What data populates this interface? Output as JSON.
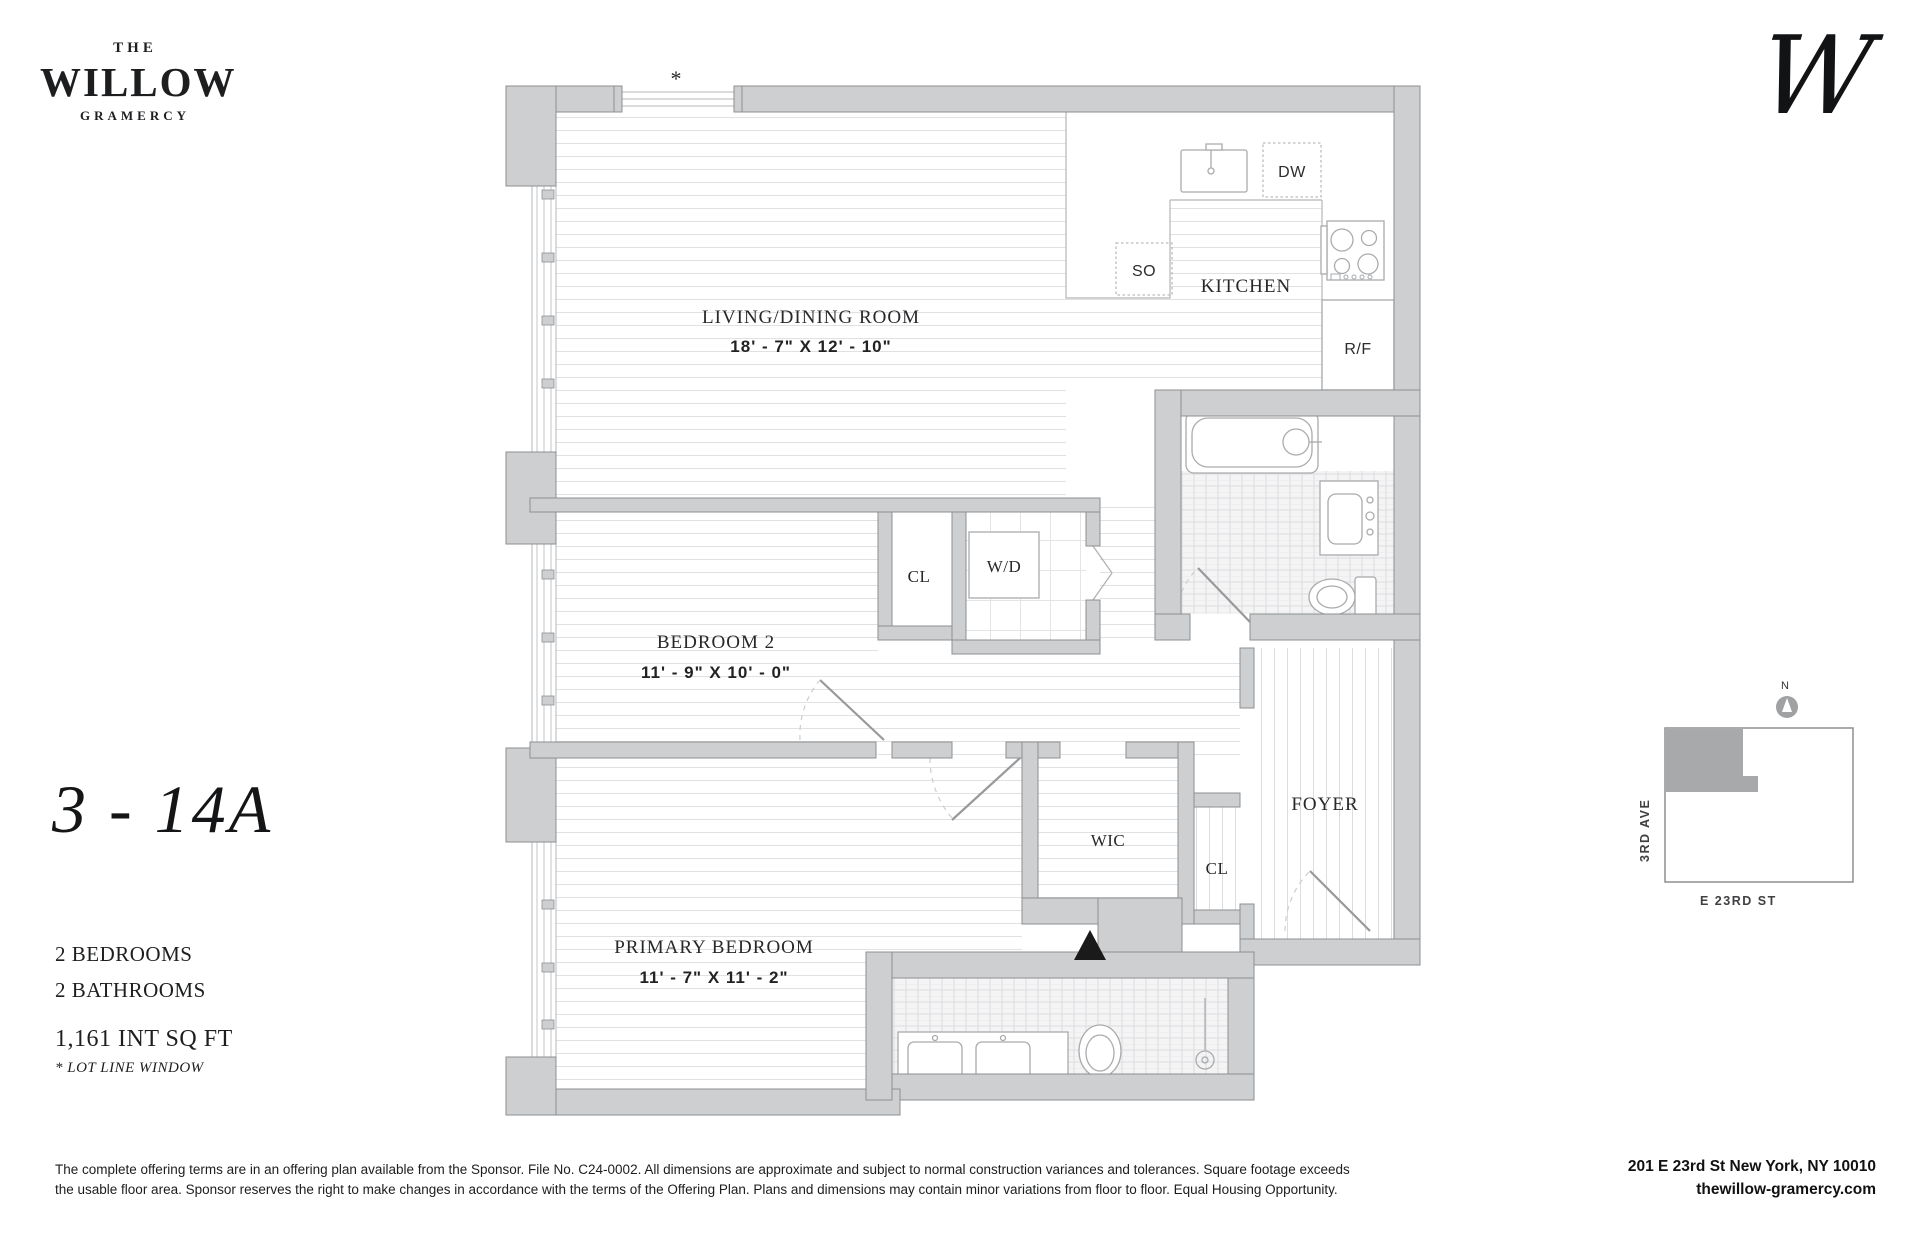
{
  "brand": {
    "the": "THE",
    "name": "WILLOW",
    "sub": "GRAMERCY",
    "monogram": "W"
  },
  "unit": {
    "number": "3 - 14A",
    "bedrooms": "2 BEDROOMS",
    "bathrooms": "2 BATHROOMS",
    "area": "1,161 INT SQ FT",
    "footnote": "* LOT LINE WINDOW"
  },
  "plan": {
    "living": {
      "name": "LIVING/DINING ROOM",
      "dims": "18' - 7\" X 12' - 10\""
    },
    "kitchen": {
      "name": "KITCHEN"
    },
    "bedroom2": {
      "name": "BEDROOM 2",
      "dims": "11' - 9\" X 10' - 0\""
    },
    "primary": {
      "name": "PRIMARY BEDROOM",
      "dims": "11' - 7\" X 11' - 2\""
    },
    "foyer": "FOYER",
    "wic": "WIC",
    "cl_bedroom": "CL",
    "cl_foyer": "CL",
    "wd": "W/D",
    "dw": "DW",
    "so": "SO",
    "rf": "R/F",
    "lot_marker": "*"
  },
  "map": {
    "north": "N",
    "street_side": "3RD AVE",
    "street_bottom": "E 23RD ST"
  },
  "footer": {
    "disclaimer_line1": "The complete offering terms are in an offering plan available from the Sponsor. File No. C24-0002.   All dimensions are approximate and subject to normal construction variances and tolerances. Square footage exceeds",
    "disclaimer_line2": "the usable floor area. Sponsor reserves the right to make changes in accordance with the terms of the Offering Plan. Plans and dimensions may contain minor variations from floor to floor.  Equal Housing Opportunity.",
    "address": "201 E 23rd St New York, NY 10010",
    "website": "thewillow-gramercy.com"
  }
}
